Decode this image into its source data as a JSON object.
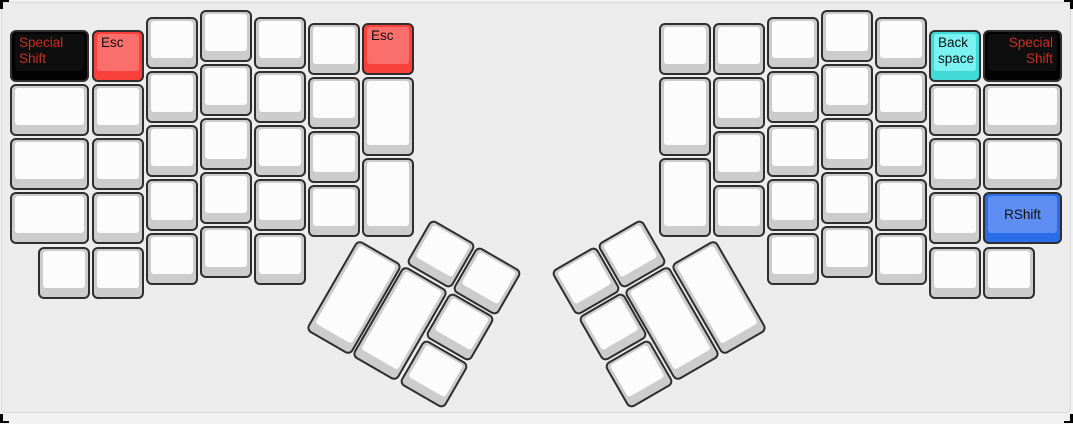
{
  "canvas": {
    "background": "#ececec",
    "page_background": "#f1f1f1",
    "panel_border_color": "#d9d9d9",
    "selection_tick_color": "#000000",
    "unit_px": 53.5
  },
  "palette": {
    "default": {
      "base": "#cccccc",
      "top": "#fcfcfc",
      "text": "#1a1a1a"
    },
    "red": {
      "base": "#f9413c",
      "top": "#fa6f6c",
      "text": "#111111"
    },
    "black": {
      "base": "#020202",
      "top": "#0e0e0e",
      "text": "#c62f22"
    },
    "cyan": {
      "base": "#41d8d8",
      "top": "#7af2f2",
      "text": "#111111"
    },
    "blue": {
      "base": "#2b6ce8",
      "top": "#5e8ef2",
      "text": "#111111"
    }
  },
  "labels": {
    "special_shift": "Special Shift",
    "esc": "Esc",
    "backspace": "Back space",
    "rshift": "RShift"
  },
  "keys": [
    {
      "name": "key-special-shift-left",
      "label": "Special Shift",
      "color": "black",
      "align": "tl",
      "x": 10,
      "y": 30,
      "w": 79,
      "h": 52
    },
    {
      "x": 10,
      "y": 84,
      "w": 79,
      "h": 52
    },
    {
      "x": 10,
      "y": 138,
      "w": 79,
      "h": 52
    },
    {
      "x": 10,
      "y": 192,
      "w": 79,
      "h": 52
    },
    {
      "x": 38,
      "y": 247,
      "w": 52,
      "h": 52
    },
    {
      "name": "key-esc-left",
      "label": "Esc",
      "color": "red",
      "align": "tl",
      "x": 92,
      "y": 30,
      "w": 52,
      "h": 52
    },
    {
      "x": 92,
      "y": 84,
      "w": 52,
      "h": 52
    },
    {
      "x": 92,
      "y": 138,
      "w": 52,
      "h": 52
    },
    {
      "x": 92,
      "y": 192,
      "w": 52,
      "h": 52
    },
    {
      "x": 92,
      "y": 247,
      "w": 52,
      "h": 52
    },
    {
      "x": 146,
      "y": 17,
      "w": 52,
      "h": 52
    },
    {
      "x": 146,
      "y": 71,
      "w": 52,
      "h": 52
    },
    {
      "x": 146,
      "y": 125,
      "w": 52,
      "h": 52
    },
    {
      "x": 146,
      "y": 179,
      "w": 52,
      "h": 52
    },
    {
      "x": 146,
      "y": 233,
      "w": 52,
      "h": 52
    },
    {
      "x": 200,
      "y": 10,
      "w": 52,
      "h": 52
    },
    {
      "x": 200,
      "y": 64,
      "w": 52,
      "h": 52
    },
    {
      "x": 200,
      "y": 118,
      "w": 52,
      "h": 52
    },
    {
      "x": 200,
      "y": 172,
      "w": 52,
      "h": 52
    },
    {
      "x": 200,
      "y": 226,
      "w": 52,
      "h": 52
    },
    {
      "x": 254,
      "y": 17,
      "w": 52,
      "h": 52
    },
    {
      "x": 254,
      "y": 71,
      "w": 52,
      "h": 52
    },
    {
      "x": 254,
      "y": 125,
      "w": 52,
      "h": 52
    },
    {
      "x": 254,
      "y": 179,
      "w": 52,
      "h": 52
    },
    {
      "x": 254,
      "y": 233,
      "w": 52,
      "h": 52
    },
    {
      "x": 308,
      "y": 23,
      "w": 52,
      "h": 52
    },
    {
      "x": 308,
      "y": 77,
      "w": 52,
      "h": 52
    },
    {
      "x": 308,
      "y": 131,
      "w": 52,
      "h": 52
    },
    {
      "x": 308,
      "y": 185,
      "w": 52,
      "h": 52
    },
    {
      "name": "key-esc-inner-left",
      "label": "Esc",
      "color": "red",
      "align": "tl",
      "x": 362,
      "y": 23,
      "w": 52,
      "h": 52
    },
    {
      "x": 362,
      "y": 77,
      "w": 52,
      "h": 79
    },
    {
      "x": 362,
      "y": 158,
      "w": 52,
      "h": 79
    },
    {
      "name": "key-thumb-blank",
      "x": 415,
      "y": 228,
      "w": 52,
      "h": 52,
      "rot": 30
    },
    {
      "name": "key-thumb-blank",
      "x": 461,
      "y": 255,
      "w": 52,
      "h": 52,
      "rot": 30
    },
    {
      "name": "key-thumb-blank",
      "x": 328,
      "y": 245,
      "w": 52,
      "h": 105,
      "rot": 30
    },
    {
      "name": "key-thumb-blank",
      "x": 374,
      "y": 271,
      "w": 52,
      "h": 105,
      "rot": 30
    },
    {
      "name": "key-thumb-blank",
      "x": 434,
      "y": 301,
      "w": 52,
      "h": 52,
      "rot": 30
    },
    {
      "name": "key-thumb-blank",
      "x": 408,
      "y": 348,
      "w": 52,
      "h": 52,
      "rot": 30
    },
    {
      "x": 659,
      "y": 23,
      "w": 52,
      "h": 52
    },
    {
      "x": 659,
      "y": 77,
      "w": 52,
      "h": 79
    },
    {
      "x": 659,
      "y": 158,
      "w": 52,
      "h": 79
    },
    {
      "x": 713,
      "y": 23,
      "w": 52,
      "h": 52
    },
    {
      "x": 713,
      "y": 77,
      "w": 52,
      "h": 52
    },
    {
      "x": 713,
      "y": 131,
      "w": 52,
      "h": 52
    },
    {
      "x": 713,
      "y": 185,
      "w": 52,
      "h": 52
    },
    {
      "x": 767,
      "y": 17,
      "w": 52,
      "h": 52
    },
    {
      "x": 767,
      "y": 71,
      "w": 52,
      "h": 52
    },
    {
      "x": 767,
      "y": 125,
      "w": 52,
      "h": 52
    },
    {
      "x": 767,
      "y": 179,
      "w": 52,
      "h": 52
    },
    {
      "x": 767,
      "y": 233,
      "w": 52,
      "h": 52
    },
    {
      "x": 821,
      "y": 10,
      "w": 52,
      "h": 52
    },
    {
      "x": 821,
      "y": 64,
      "w": 52,
      "h": 52
    },
    {
      "x": 821,
      "y": 118,
      "w": 52,
      "h": 52
    },
    {
      "x": 821,
      "y": 172,
      "w": 52,
      "h": 52
    },
    {
      "x": 821,
      "y": 226,
      "w": 52,
      "h": 52
    },
    {
      "x": 875,
      "y": 17,
      "w": 52,
      "h": 52
    },
    {
      "x": 875,
      "y": 71,
      "w": 52,
      "h": 52
    },
    {
      "x": 875,
      "y": 125,
      "w": 52,
      "h": 52
    },
    {
      "x": 875,
      "y": 179,
      "w": 52,
      "h": 52
    },
    {
      "x": 875,
      "y": 233,
      "w": 52,
      "h": 52
    },
    {
      "name": "key-backspace",
      "label": "Back space",
      "color": "cyan",
      "align": "tl",
      "x": 929,
      "y": 30,
      "w": 52,
      "h": 52
    },
    {
      "x": 929,
      "y": 84,
      "w": 52,
      "h": 52
    },
    {
      "x": 929,
      "y": 138,
      "w": 52,
      "h": 52
    },
    {
      "x": 929,
      "y": 192,
      "w": 52,
      "h": 52
    },
    {
      "x": 929,
      "y": 247,
      "w": 52,
      "h": 52
    },
    {
      "name": "key-special-shift-right",
      "label": "Special Shift",
      "color": "black",
      "align": "tr",
      "x": 983,
      "y": 30,
      "w": 79,
      "h": 52
    },
    {
      "x": 983,
      "y": 84,
      "w": 79,
      "h": 52
    },
    {
      "x": 983,
      "y": 138,
      "w": 79,
      "h": 52
    },
    {
      "name": "key-rshift",
      "label": "RShift",
      "color": "blue",
      "align": "c",
      "x": 983,
      "y": 192,
      "w": 79,
      "h": 52
    },
    {
      "x": 983,
      "y": 247,
      "w": 52,
      "h": 52
    },
    {
      "name": "key-thumb-blank",
      "x": 606,
      "y": 228,
      "w": 52,
      "h": 52,
      "rot": -30
    },
    {
      "name": "key-thumb-blank",
      "x": 560,
      "y": 255,
      "w": 52,
      "h": 52,
      "rot": -30
    },
    {
      "name": "key-thumb-blank",
      "x": 693,
      "y": 245,
      "w": 52,
      "h": 105,
      "rot": -30
    },
    {
      "name": "key-thumb-blank",
      "x": 646,
      "y": 271,
      "w": 52,
      "h": 105,
      "rot": -30
    },
    {
      "name": "key-thumb-blank",
      "x": 587,
      "y": 301,
      "w": 52,
      "h": 52,
      "rot": -30
    },
    {
      "name": "key-thumb-blank",
      "x": 613,
      "y": 348,
      "w": 52,
      "h": 52,
      "rot": -30
    }
  ]
}
